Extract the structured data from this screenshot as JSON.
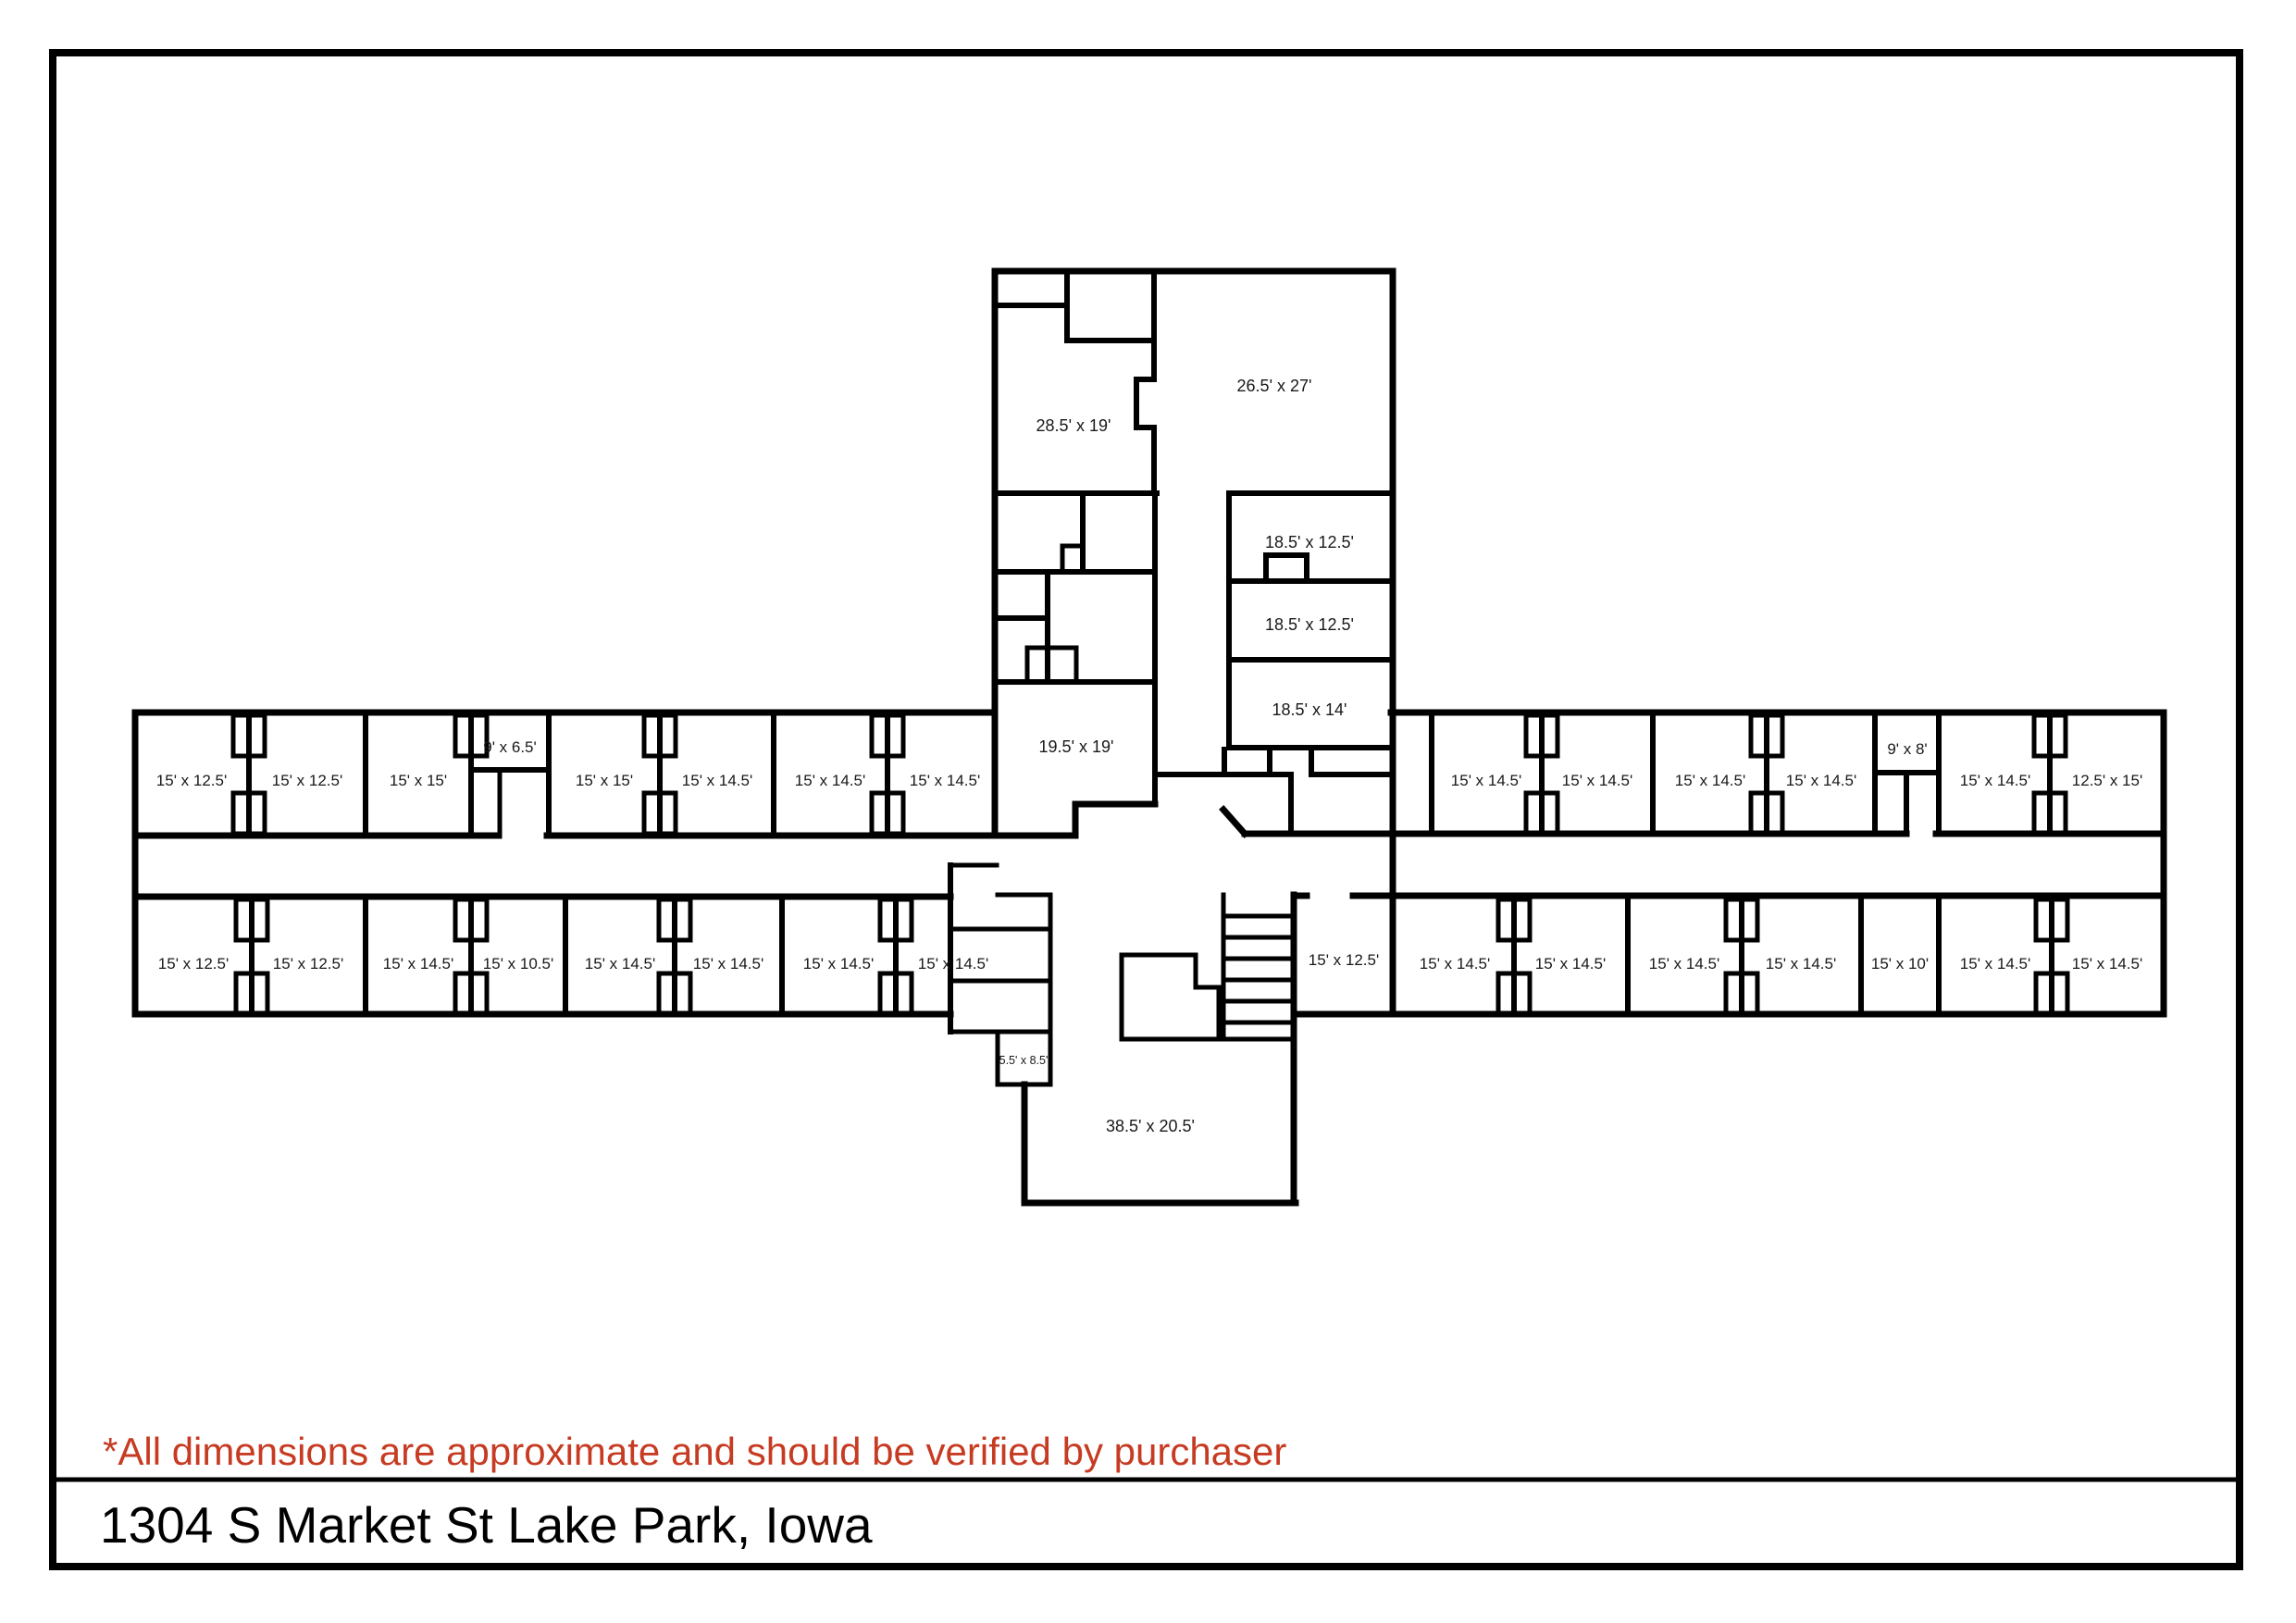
{
  "page": {
    "title": "1304 S Market St Lake Park, Iowa",
    "disclaimer": "*All dimensions are approximate and should be verified by purchaser",
    "disclaimer_color": "#c63b22",
    "wall_color": "#000000",
    "background_color": "#ffffff"
  },
  "plan": {
    "rooms": [
      {
        "label": "15' x 12.5'"
      },
      {
        "label": "15' x 12.5'"
      },
      {
        "label": "15' x 15'"
      },
      {
        "label": "9' x 6.5'"
      },
      {
        "label": "15' x 15'"
      },
      {
        "label": "15' x 14.5'"
      },
      {
        "label": "15' x 14.5'"
      },
      {
        "label": "15' x 14.5'"
      },
      {
        "label": "15' x 14.5'"
      },
      {
        "label": "15' x 14.5'"
      },
      {
        "label": "15' x 14.5'"
      },
      {
        "label": "15' x 14.5'"
      },
      {
        "label": "9' x 8'"
      },
      {
        "label": "15' x 14.5'"
      },
      {
        "label": "12.5' x 15'"
      },
      {
        "label": "15' x 12.5'"
      },
      {
        "label": "15' x 12.5'"
      },
      {
        "label": "15' x 14.5'"
      },
      {
        "label": "15' x 10.5'"
      },
      {
        "label": "15' x 14.5'"
      },
      {
        "label": "15' x 14.5'"
      },
      {
        "label": "15' x 14.5'"
      },
      {
        "label": "15' x 14.5'"
      },
      {
        "label": "15' x 12.5'"
      },
      {
        "label": "15' x 14.5'"
      },
      {
        "label": "15' x 14.5'"
      },
      {
        "label": "15' x 14.5'"
      },
      {
        "label": "15' x 14.5'"
      },
      {
        "label": "15' x 10'"
      },
      {
        "label": "15' x 14.5'"
      },
      {
        "label": "15' x 14.5'"
      },
      {
        "label": "28.5' x 19'"
      },
      {
        "label": "26.5' x 27'"
      },
      {
        "label": "18.5' x 12.5'"
      },
      {
        "label": "18.5' x 12.5'"
      },
      {
        "label": "18.5' x 14'"
      },
      {
        "label": "19.5' x 19'"
      },
      {
        "label": "5.5' x 8.5'"
      },
      {
        "label": "38.5' x 20.5'"
      }
    ]
  }
}
